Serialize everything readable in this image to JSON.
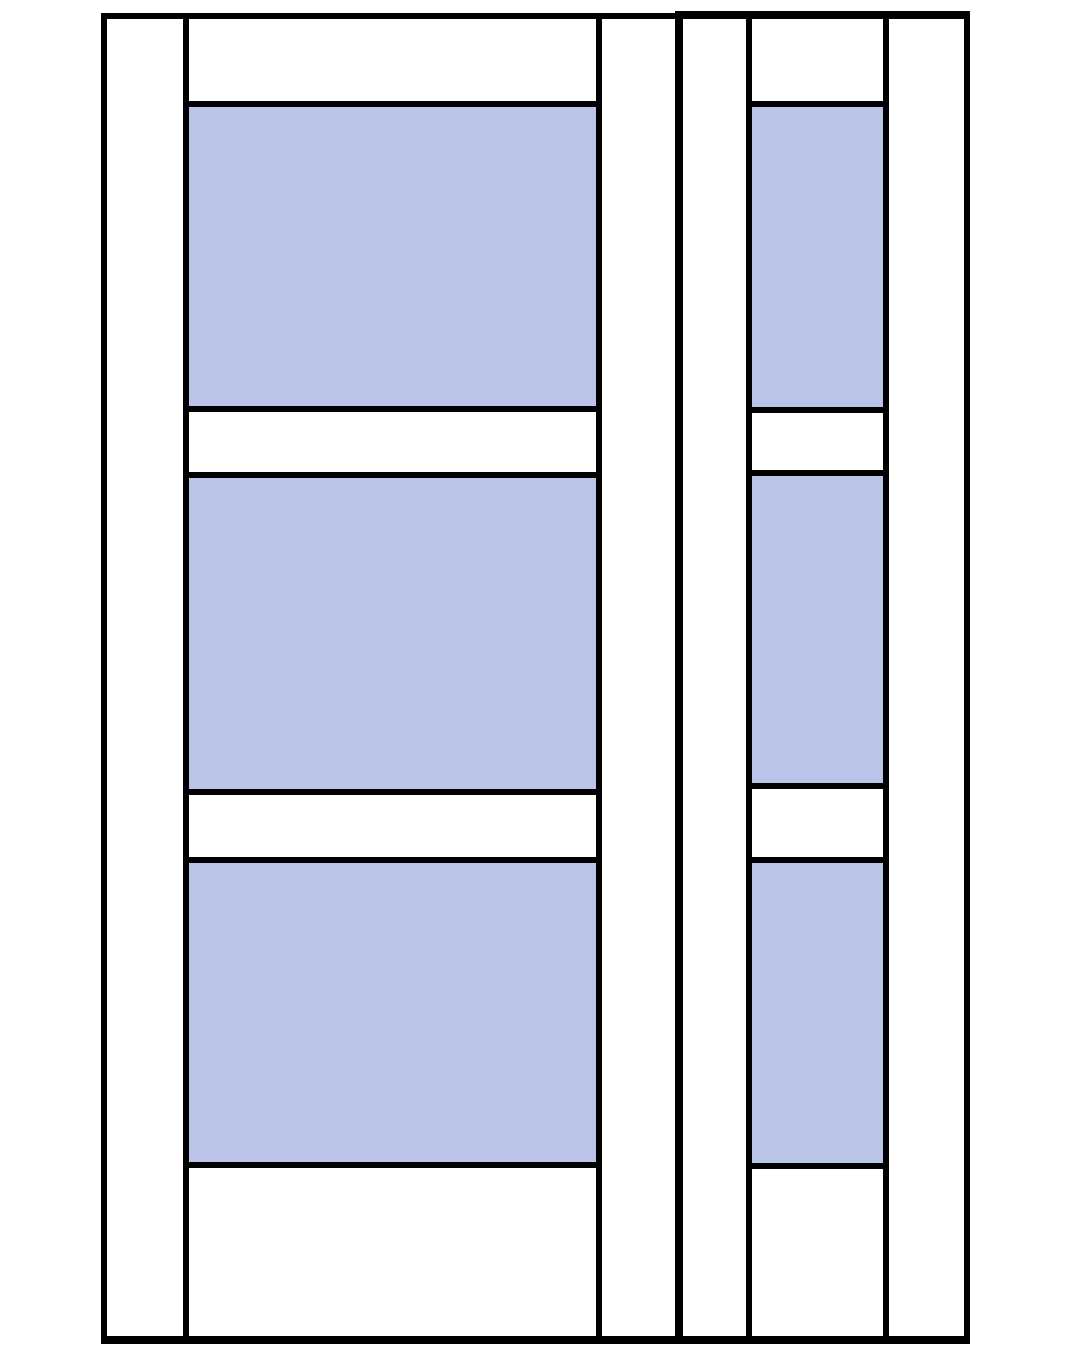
{
  "diagram": {
    "description": "door-with-sidelite-elevation",
    "background_color": "#ffffff",
    "frame_color": "#000000",
    "glass_color": "#b9c4e8",
    "door": {
      "glass_panel_count": 3,
      "outer": {
        "x": 101,
        "y": 13,
        "w": 582,
        "h": 1331
      },
      "border": {
        "top": 6,
        "right": 8,
        "bottom": 8,
        "left": 6
      },
      "stile_lines": [
        {
          "name": "door-stile-line-left",
          "x": 183,
          "y": 19,
          "w": 6,
          "h": 1317
        },
        {
          "name": "door-stile-line-right",
          "x": 596,
          "y": 19,
          "w": 6,
          "h": 1317
        }
      ],
      "rail_lines": [
        {
          "name": "door-rail-line-panel1-top",
          "x": 183,
          "y": 101,
          "w": 419,
          "h": 6
        },
        {
          "name": "door-rail-line-panel1-bottom",
          "x": 183,
          "y": 406,
          "w": 419,
          "h": 6
        },
        {
          "name": "door-rail-line-panel2-top",
          "x": 183,
          "y": 472,
          "w": 419,
          "h": 6
        },
        {
          "name": "door-rail-line-panel2-bottom",
          "x": 183,
          "y": 789,
          "w": 419,
          "h": 6
        },
        {
          "name": "door-rail-line-panel3-top",
          "x": 183,
          "y": 857,
          "w": 419,
          "h": 6
        },
        {
          "name": "door-rail-line-panel3-bottom",
          "x": 183,
          "y": 1162,
          "w": 419,
          "h": 6
        }
      ],
      "glass_panels": [
        {
          "name": "door-glass-panel-1",
          "x": 189,
          "y": 107,
          "w": 407,
          "h": 299
        },
        {
          "name": "door-glass-panel-2",
          "x": 189,
          "y": 478,
          "w": 407,
          "h": 311
        },
        {
          "name": "door-glass-panel-3",
          "x": 189,
          "y": 863,
          "w": 407,
          "h": 299
        }
      ]
    },
    "sidelite": {
      "glass_panel_count": 3,
      "outer": {
        "x": 675,
        "y": 11,
        "w": 295,
        "h": 1333
      },
      "border": {
        "top": 8,
        "right": 6,
        "bottom": 8,
        "left": 8
      },
      "stile_lines": [
        {
          "name": "sidelite-stile-line-left",
          "x": 746,
          "y": 19,
          "w": 6,
          "h": 1317
        },
        {
          "name": "sidelite-stile-line-right",
          "x": 883,
          "y": 19,
          "w": 6,
          "h": 1317
        }
      ],
      "rail_lines": [
        {
          "name": "sidelite-rail-line-panel1-top",
          "x": 746,
          "y": 101,
          "w": 143,
          "h": 6
        },
        {
          "name": "sidelite-rail-line-panel1-bottom",
          "x": 746,
          "y": 407,
          "w": 143,
          "h": 6
        },
        {
          "name": "sidelite-rail-line-panel2-top",
          "x": 746,
          "y": 470,
          "w": 143,
          "h": 6
        },
        {
          "name": "sidelite-rail-line-panel2-bottom",
          "x": 746,
          "y": 783,
          "w": 143,
          "h": 6
        },
        {
          "name": "sidelite-rail-line-panel3-top",
          "x": 746,
          "y": 857,
          "w": 143,
          "h": 6
        },
        {
          "name": "sidelite-rail-line-panel3-bottom",
          "x": 746,
          "y": 1163,
          "w": 143,
          "h": 6
        }
      ],
      "glass_panels": [
        {
          "name": "sidelite-glass-panel-1",
          "x": 752,
          "y": 107,
          "w": 131,
          "h": 300
        },
        {
          "name": "sidelite-glass-panel-2",
          "x": 752,
          "y": 476,
          "w": 131,
          "h": 307
        },
        {
          "name": "sidelite-glass-panel-3",
          "x": 752,
          "y": 863,
          "w": 131,
          "h": 300
        }
      ]
    }
  }
}
